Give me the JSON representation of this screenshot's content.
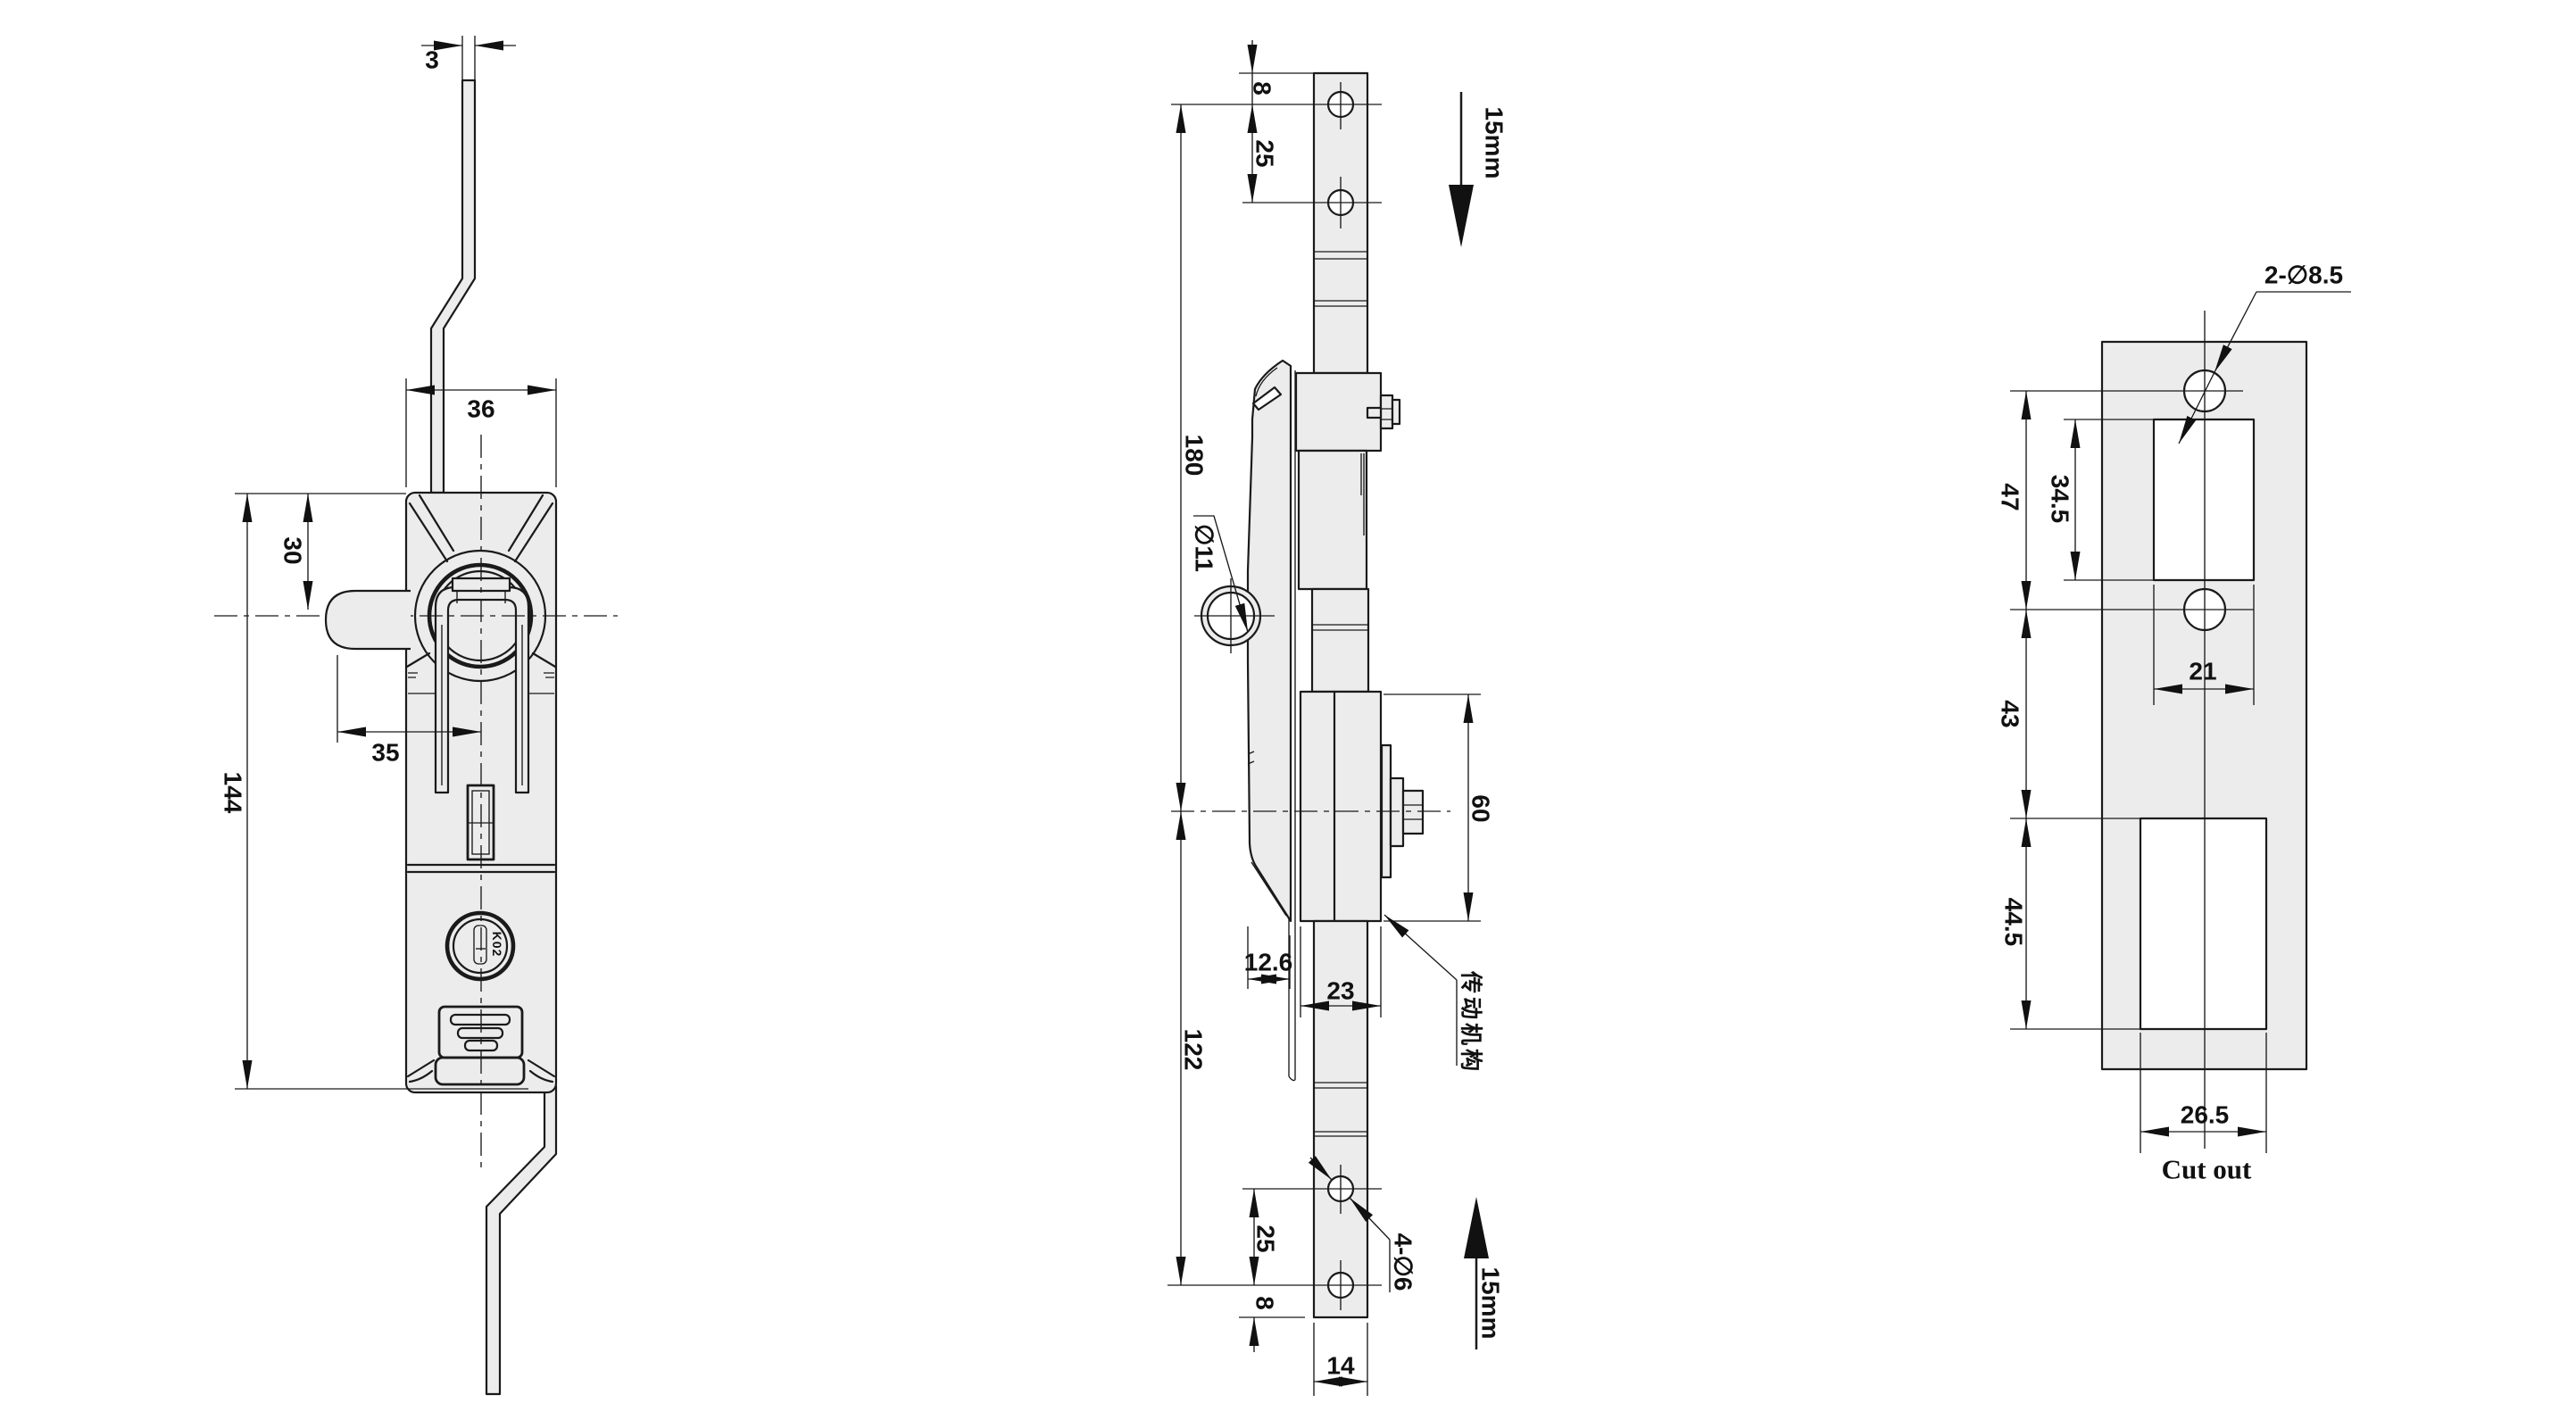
{
  "drawing_title": "Rod control swing handle lock - dimensional drawing",
  "colors": {
    "line": "#1a1a1a",
    "body_fill": "#ececec",
    "background": "#ffffff"
  },
  "front_view": {
    "dims": {
      "rod_thickness": "3",
      "body_width": "36",
      "pivot_offset": "30",
      "lever_reach": "35",
      "body_height": "144"
    },
    "key_code": "K02"
  },
  "side_view": {
    "dims": {
      "top_end_to_hole": "8",
      "top_hole_pitch": "25",
      "upper_rod_span": "180",
      "lever_hole_dia": "∅11",
      "cam_box_height": "60",
      "face_offset": "12.6",
      "cam_box_width": "23",
      "lower_rod_span": "122",
      "bottom_hole_pitch": "25",
      "bottom_hole_to_end": "8",
      "rod_width": "14",
      "rod_hole_dia": "4-∅6"
    },
    "travel_up": "15mm",
    "travel_down": "15mm",
    "transmission_label": "传动机构"
  },
  "cutout_view": {
    "dims": {
      "mount_hole_dia": "2-∅8.5",
      "hole_pitch": "47",
      "upper_cutout_height": "34.5",
      "upper_cutout_width": "21",
      "hole_to_lower_cutout": "43",
      "lower_cutout_height": "44.5",
      "lower_cutout_width": "26.5"
    },
    "caption": "Cut out"
  }
}
